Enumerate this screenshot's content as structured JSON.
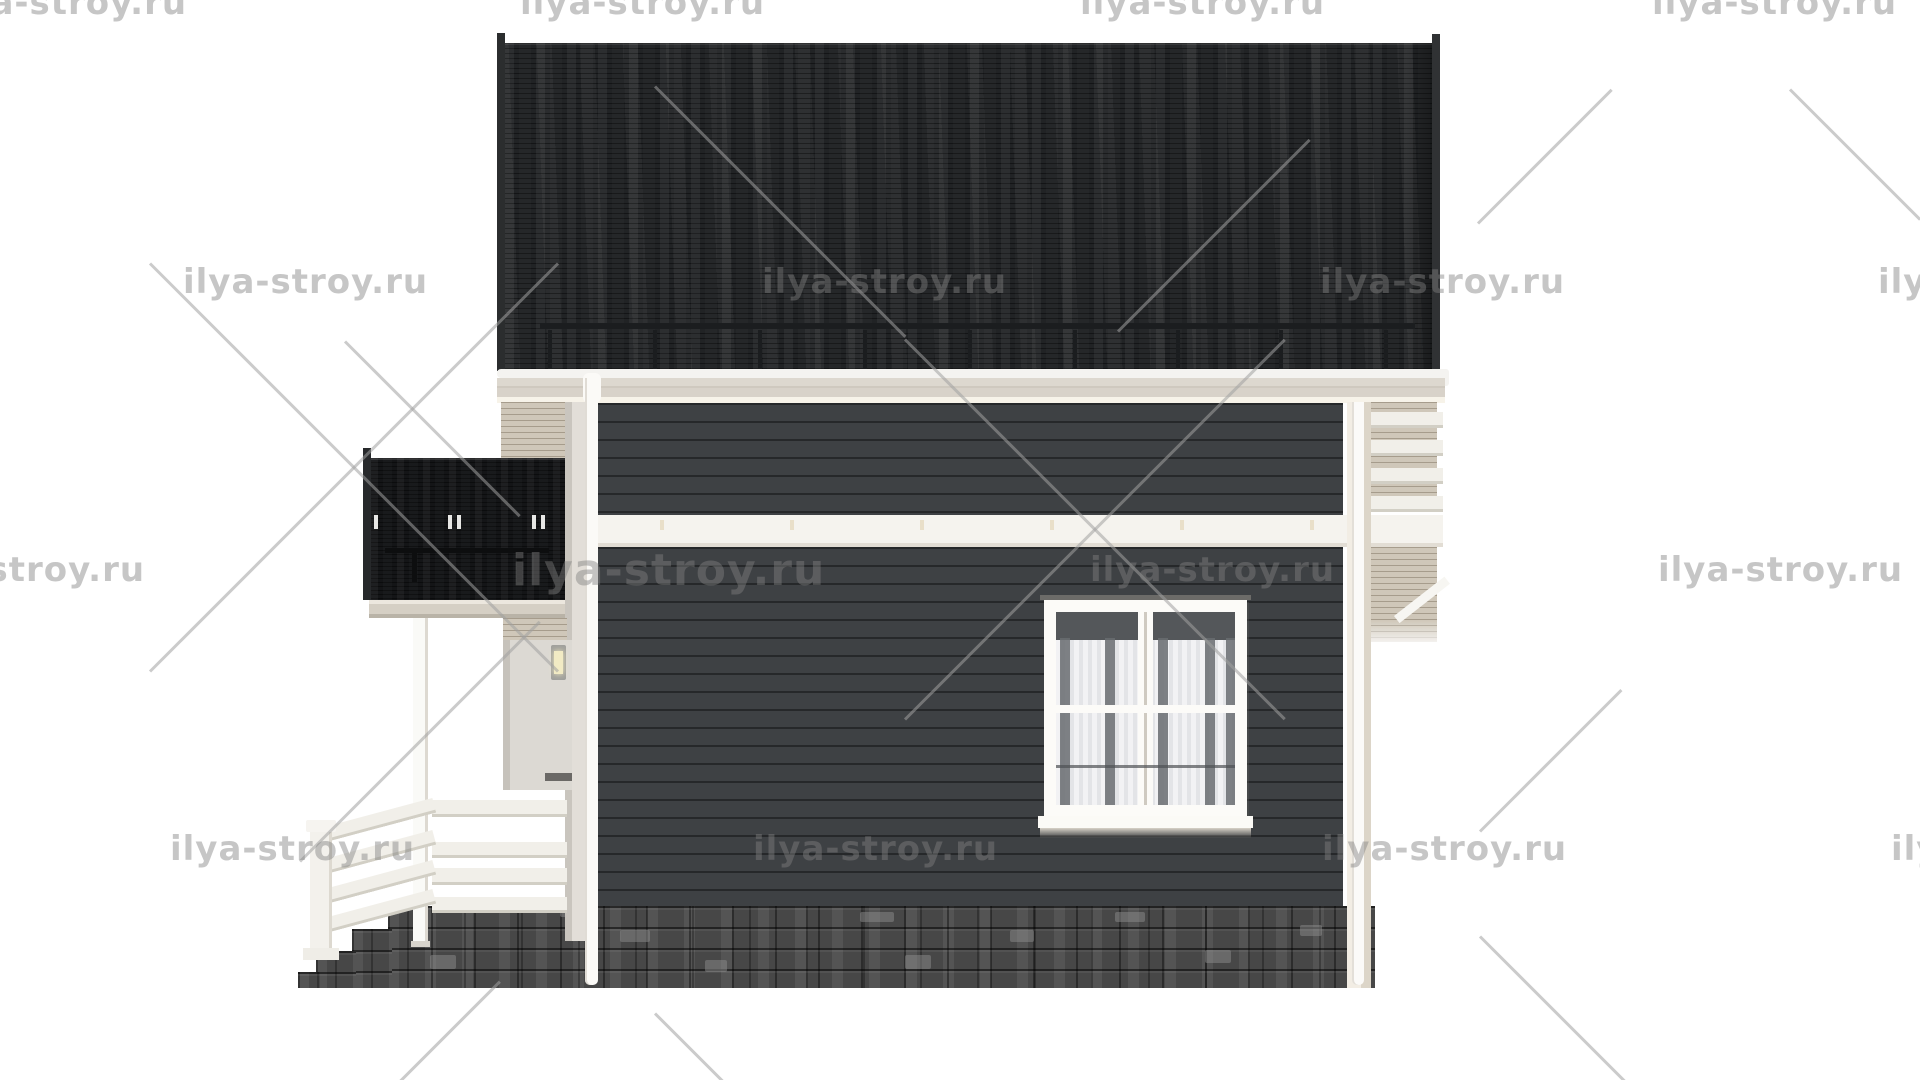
{
  "watermark": {
    "text": "ilya-stroy.ru"
  },
  "scene": {
    "description": "3D architectural rendering - side elevation of a two-storey house with dark shingle roof, dark horizontal siding, white trim, balcony, porch and stone foundation",
    "colors": {
      "background": "#ffffff",
      "watermark_text": "#c9c9c9",
      "main_roof": "#212325",
      "balcony_roof": "#141517",
      "siding": "#3e4144",
      "siding_groove": "#2a2d2f",
      "fascia": "#d8d2c9",
      "gutter_white": "#f4f3f0",
      "trim_white": "#f1efe9",
      "wood_slats": "#cfc7b9",
      "stone_foundation": "#474747",
      "window_frame": "#fcfbf8",
      "curtain": "#ededf0",
      "lamp_glow": "#f2ebc4"
    },
    "elements": [
      "main-roof",
      "snow-guard",
      "eaves-fascia",
      "gutter",
      "gable-slat-strip",
      "upper-wall-siding",
      "inter-floor-band",
      "lower-wall-siding",
      "window-with-curtains",
      "balcony-roof",
      "balcony-snow-guard",
      "porch-column",
      "porch-railing",
      "stair-railing",
      "newel-post",
      "entrance-lamp",
      "downpipes",
      "right-terrace-railing",
      "stair-stringer",
      "stone-foundation",
      "stone-steps"
    ],
    "counts": {
      "snow_guard_posts_main_roof": 9,
      "balcony_roof_clips": 5,
      "porch_railing_bars": 4,
      "stair_railing_bars": 4,
      "terrace_railing_bars": 4,
      "watermark_instances": 16
    }
  }
}
